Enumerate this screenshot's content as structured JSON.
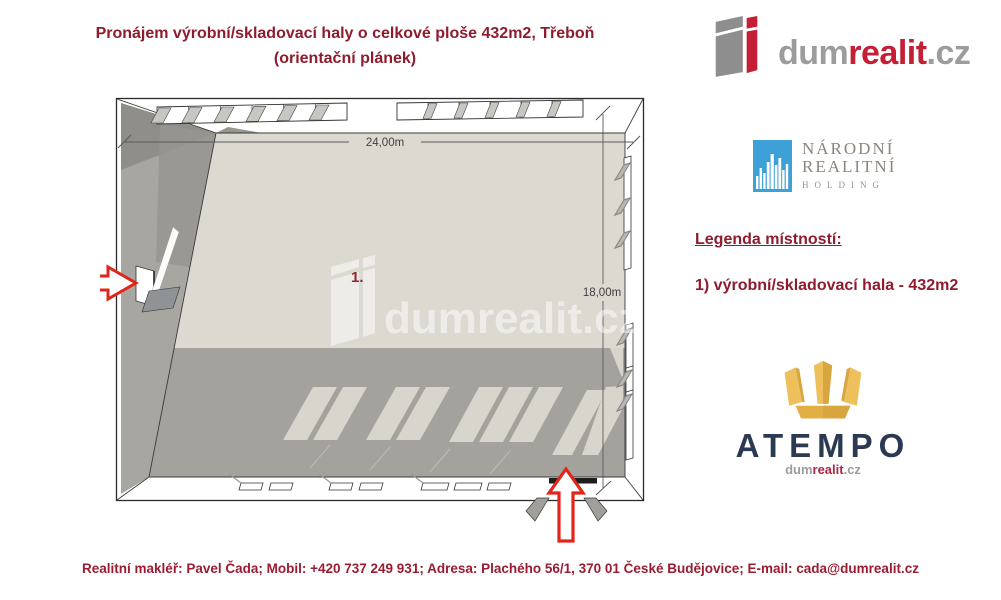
{
  "header": {
    "title_line1": "Pronájem výrobní/skladovací haly o celkové ploše 432m2, Třeboň",
    "title_line2": "(orientační plánek)"
  },
  "brand": {
    "icon": "building-i-icon",
    "part_gray": "dum",
    "part_red": "realit",
    "part_suffix": ".cz"
  },
  "nrh_logo": {
    "icon": "skyline-icon",
    "line1": "NÁRODNÍ",
    "line2": "REALITNÍ",
    "line3": "HOLDING"
  },
  "legend": {
    "heading": "Legenda místností:",
    "items": [
      {
        "label": "1) výrobní/skladovací hala - 432m2"
      }
    ]
  },
  "atempo": {
    "icon": "crown-icon",
    "name": "ATEMPO",
    "sub_gray": "dum",
    "sub_red": "realit",
    "sub_suffix": ".cz"
  },
  "plan": {
    "width_label": "24,00m",
    "height_label": "18,00m",
    "room_number": "1.",
    "watermark": "dumrealit.cz"
  },
  "footer": {
    "text": "Realitní makléř: Pavel Čada; Mobil: +420 737 249 931; Adresa: Plachého 56/1, 370 01 České Budějovice; E-mail: cada@dumrealit.cz"
  },
  "colors": {
    "title_red": "#8e1c2e",
    "footer_red": "#9b1c31",
    "brand_red": "#c41f35",
    "brand_gray": "#9c9c9c",
    "nrh_blue": "#3da0d6",
    "atempo_navy": "#2b3a52",
    "atempo_gold": "#e9b94e",
    "arrow_red": "#e1251b",
    "floor_light": "#dcd9d1",
    "floor_shadow": "#a4a29c",
    "wall_gray": "#a7a6a1"
  }
}
